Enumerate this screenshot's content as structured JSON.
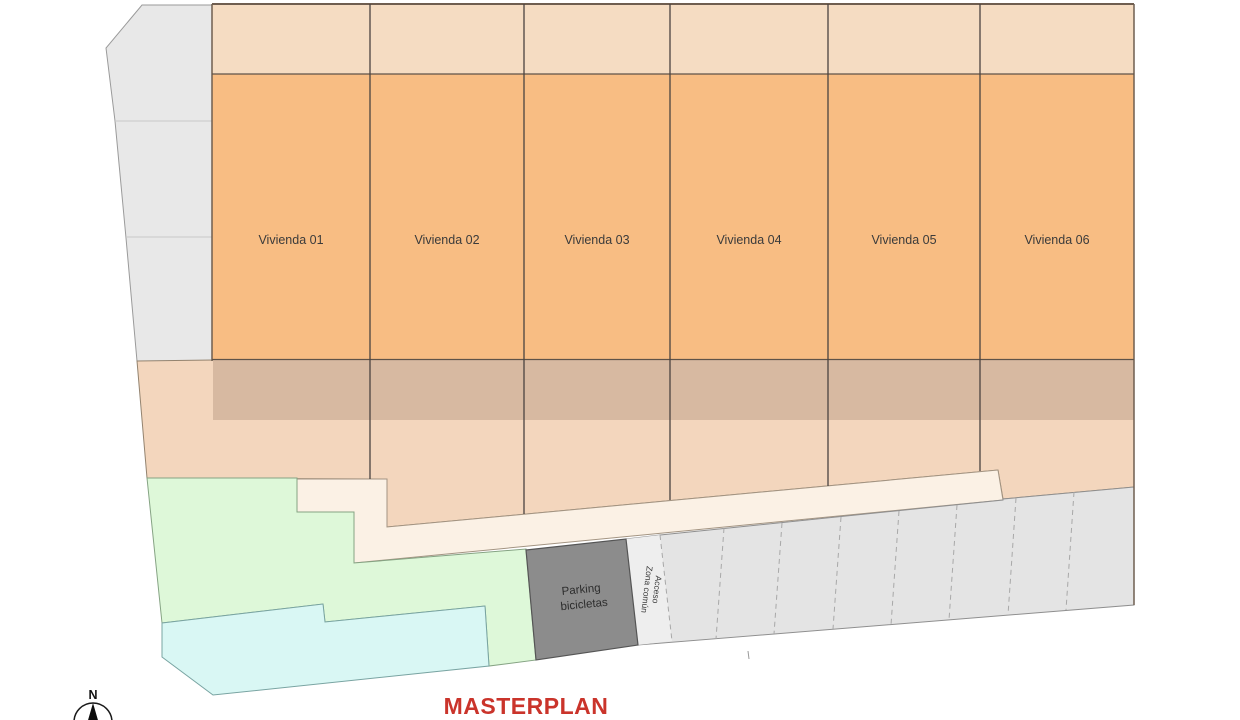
{
  "title": {
    "text": "MASTERPLAN",
    "color": "#ca342b"
  },
  "compass": {
    "north_label": "N"
  },
  "units": [
    {
      "label": "Vivienda 01"
    },
    {
      "label": "Vivienda 02"
    },
    {
      "label": "Vivienda 03"
    },
    {
      "label": "Vivienda 04"
    },
    {
      "label": "Vivienda 05"
    },
    {
      "label": "Vivienda 06"
    }
  ],
  "zones": {
    "bike_parking": {
      "line1": "Parking",
      "line2": "bicicletas"
    },
    "common_access": {
      "line1": "Acceso",
      "line2": "Zona común"
    }
  },
  "colors": {
    "unit_fill": "#f8bd83",
    "unit_front_strip": "#f5dcc2",
    "terrace_band": "#d7b9a1",
    "garden_peach": "#f3d6bd",
    "path_cream": "#fbf1e5",
    "green_area": "#def8d9",
    "pool_area": "#d9f7f4",
    "plot_gray": "#e8e8e8",
    "parking_gray": "#e4e4e4",
    "access_strip_gray": "#eeeeee",
    "bike_parking_gray": "#8c8c8c",
    "title_red": "#ca342b"
  }
}
